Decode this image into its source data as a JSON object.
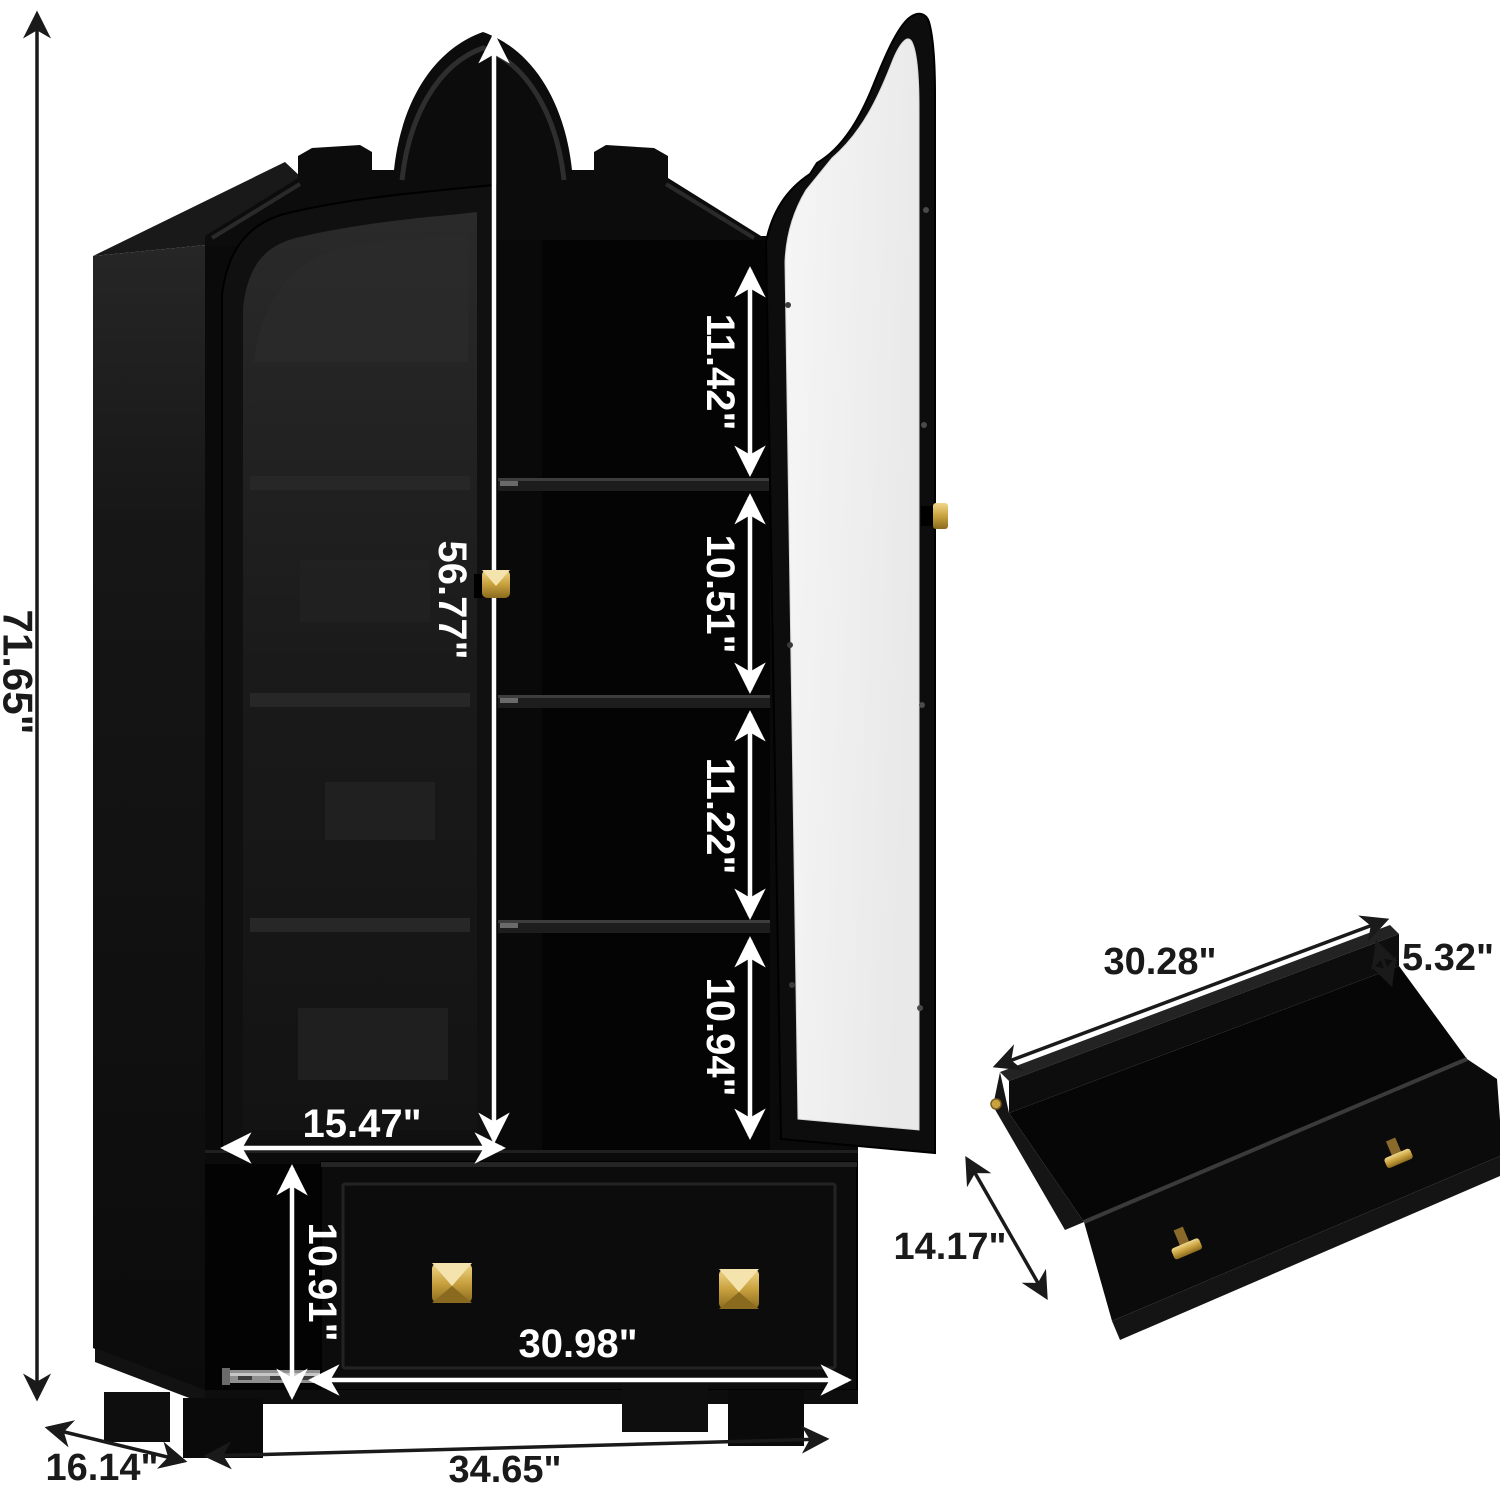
{
  "image_type": "product-dimension-diagram",
  "product": "Arched display cabinet with glass doors, shelves and bottom drawer",
  "colors": {
    "background": "#ffffff",
    "cabinet_black": "#0a0a0a",
    "side_panel_gray": "#1e1e1e",
    "tinted_glass": "#1f1f1f",
    "open_door_glass": "#f3f3f3",
    "knob_gold": "#c9a23f",
    "dimension_white": "#ffffff",
    "dimension_black": "#1a1a1a",
    "slide_rail_gray": "#8f8f8f"
  },
  "cabinet": {
    "overall_height": "71.65\"",
    "overall_depth": "16.14\"",
    "overall_width": "34.65\"",
    "glass_door": {
      "height": "56.77\"",
      "width": "15.47\""
    },
    "shelf_openings": [
      "11.42\"",
      "10.51\"",
      "11.22\"",
      "10.94\""
    ],
    "drawer_front": {
      "height": "10.91\"",
      "width": "30.98\""
    }
  },
  "drawer_detail": {
    "width": "30.28\"",
    "thickness": "5.32\"",
    "depth": "14.17\""
  }
}
